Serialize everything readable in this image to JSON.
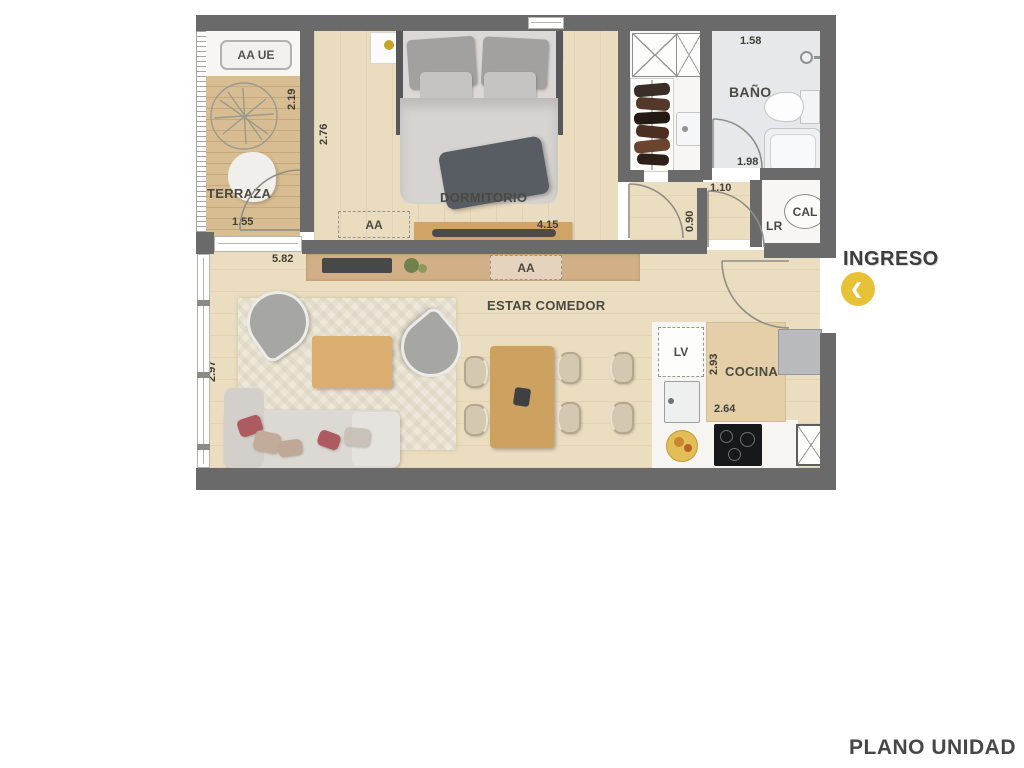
{
  "page": {
    "title": "PLANO UNIDAD"
  },
  "entry": {
    "label": "INGRESO"
  },
  "icons": {
    "entry_chevron": "❮"
  },
  "rooms": {
    "terraza": "TERRAZA",
    "dormitorio": "DORMITORIO",
    "bano": "BAÑO",
    "estar_comedor": "ESTAR COMEDOR",
    "cocina": "COCINA"
  },
  "equipment": {
    "terrace_ac_unit": "AA UE",
    "bedroom_ac": "AA",
    "living_ac": "AA",
    "water_heater": "CAL",
    "laundry": "LR",
    "dishwasher": "LV"
  },
  "dims": {
    "terraza_width": "1.55",
    "terraza_depth": "2.19",
    "bedroom_depth": "2.76",
    "bedroom_width": "4.15",
    "living_width": "5.82",
    "living_depth": "2.97",
    "bath_top_width": "1.58",
    "bath_depth": "1.90",
    "bath_width": "1.98",
    "hall_door_width": "1.10",
    "hall_width": "0.90",
    "kitchen_depth": "2.93",
    "kitchen_width": "2.64"
  },
  "colors": {
    "wall": "#6A6A6A",
    "wood_floor": "#EADCBE",
    "deck": "#D9BD92",
    "bath_floor": "#E6E8EB",
    "accent_yellow": "#E7C138",
    "text": "#45453F"
  }
}
